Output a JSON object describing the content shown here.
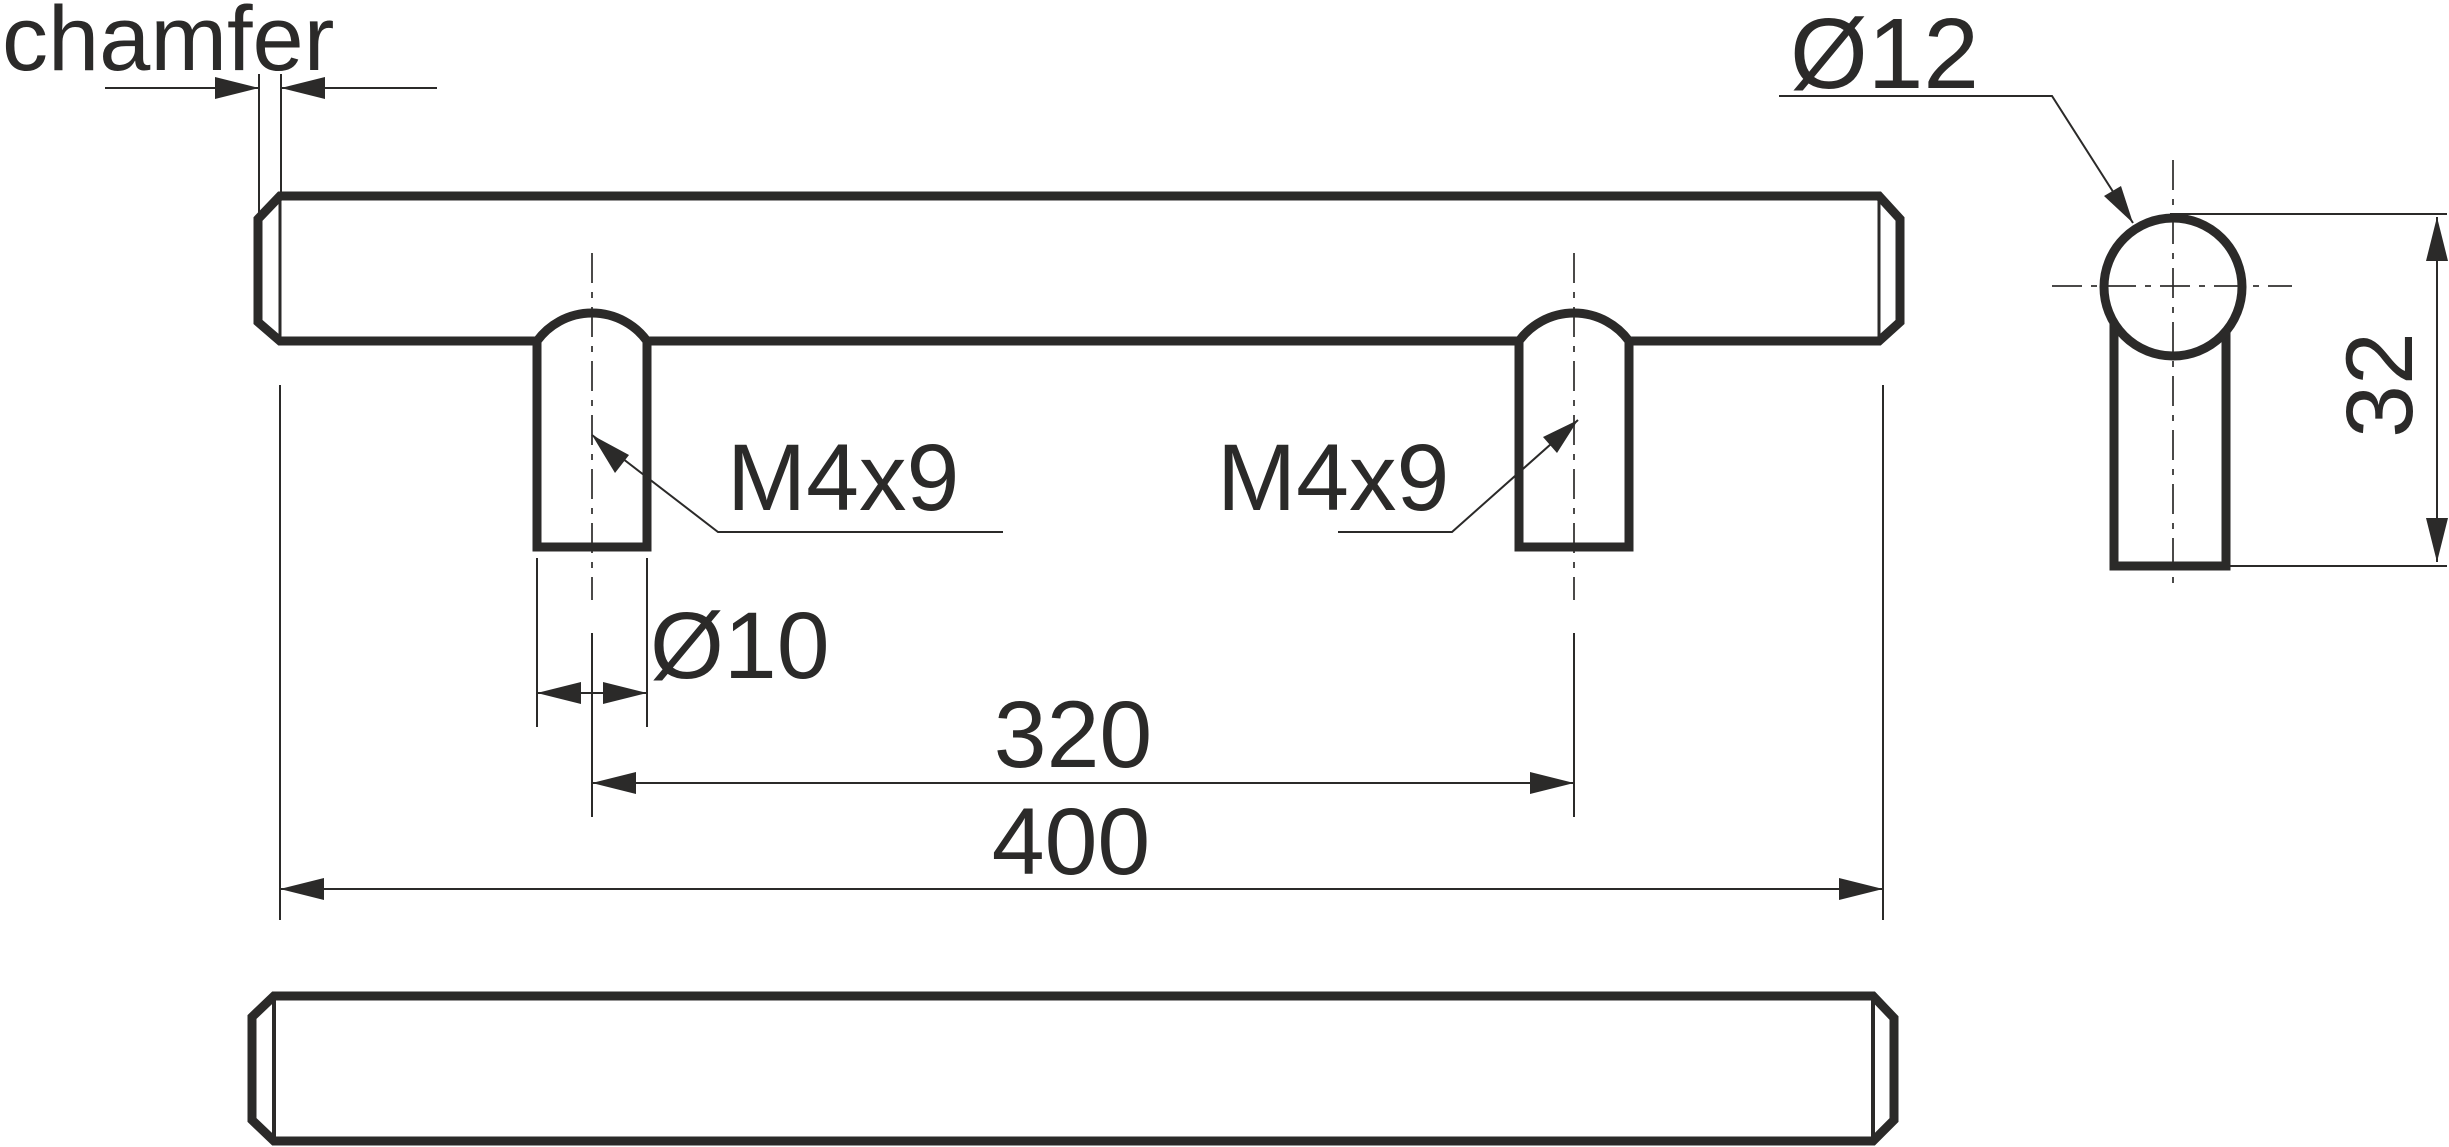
{
  "labels": {
    "chamfer": "chamfer",
    "thread_left": "M4x9",
    "thread_right": "M4x9",
    "post_diameter": "Ø10",
    "bar_diameter": "Ø12",
    "hole_spacing": "320",
    "total_length": "400",
    "side_height": "32"
  },
  "colors": {
    "line": "#2b2a29",
    "background": "#ffffff"
  }
}
